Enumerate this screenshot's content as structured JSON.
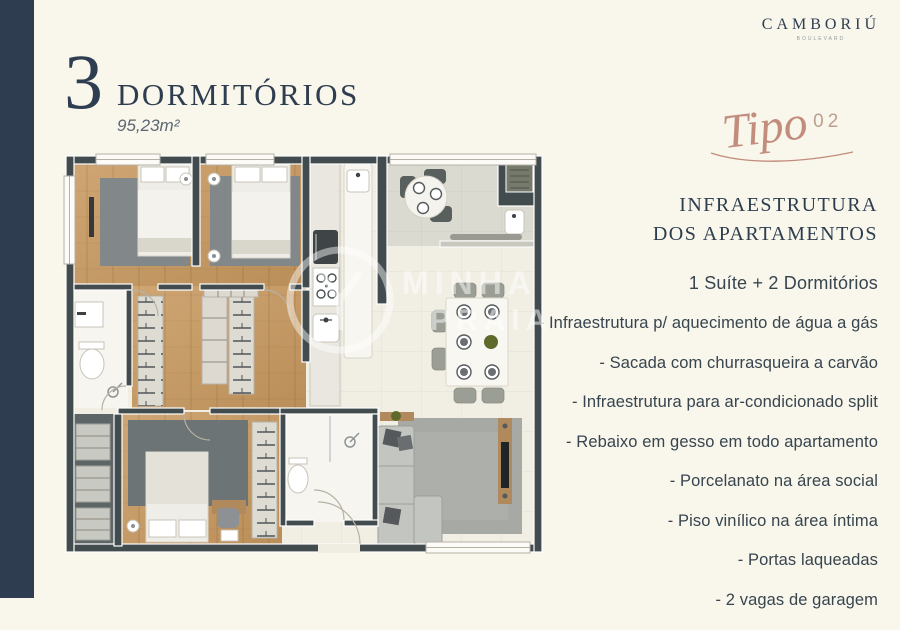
{
  "colors": {
    "cream": "#f9f6eb",
    "navy": "#2e3e50",
    "ink": "#2c3e4e",
    "body": "#37454f",
    "rose": "#c28d7c",
    "wall": "#424b4d",
    "wood": "#c89e6c",
    "tile": "#f1eee4"
  },
  "brand": {
    "name": "CAMBORIÚ",
    "tagline": "BOULEVARD"
  },
  "title": {
    "number": "3",
    "label": "DORMITÓRIOS",
    "area": "95,23m²"
  },
  "tipo": {
    "label": "Tipo",
    "number": "02"
  },
  "info": {
    "heading_line1": "INFRAESTRUTURA",
    "heading_line2": "DOS APARTAMENTOS",
    "subtitle": "1 Suíte + 2 Dormitórios",
    "items": [
      "- Infraestrutura p/ aquecimento de água a gás",
      "- Sacada com churrasqueira a carvão",
      "- Infraestrutura para ar-condicionado split",
      "- Rebaixo em gesso em todo apartamento",
      "- Porcelanato na área social",
      "- Piso vinílico na área íntima",
      "- Portas laqueadas",
      "- 2 vagas de garagem"
    ]
  },
  "watermark": {
    "line1": "MINHA",
    "line2": "PRAIA"
  }
}
